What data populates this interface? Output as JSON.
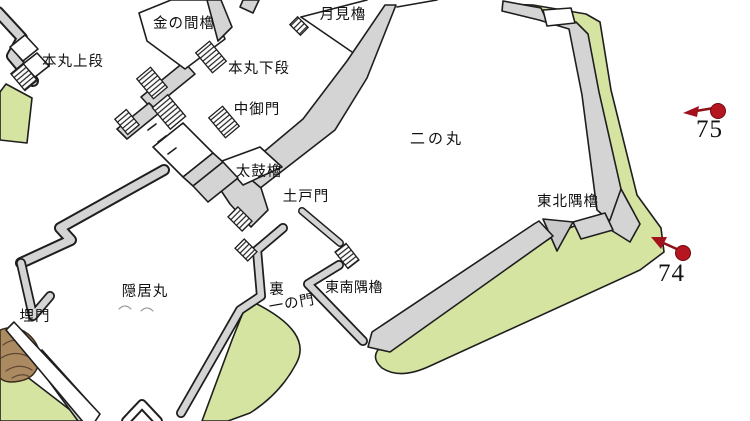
{
  "map": {
    "title": "castle layout map",
    "area_labels": {
      "kin_no_ma_yagura": "金の間櫓",
      "tsukimi_yagura": "月見櫓",
      "honmaru_jodan": "本丸上段",
      "honmaru_gedan": "本丸下段",
      "naka_gomon": "中御門",
      "taiko_yagura": "太鼓櫓",
      "tsuchido_mon": "土戸門",
      "ninomaru": "二の丸",
      "tohoku_sumi_yagura": "東北隅櫓",
      "inkyo_maru": "隠居丸",
      "ura_line1": "裏",
      "ura_line2": "一の門",
      "tonan_sumi_yagura": "東南隅櫓",
      "uzumi_mon": "埋門"
    },
    "markers": [
      {
        "number": "75"
      },
      {
        "number": "74"
      }
    ],
    "colors": {
      "slope_green": "#d5e4a1",
      "wall_grey": "#d4d4d4",
      "rock_brown": "#ab8a61",
      "marker_red": "#b5161f",
      "line_ink": "#1e1e1e"
    }
  }
}
